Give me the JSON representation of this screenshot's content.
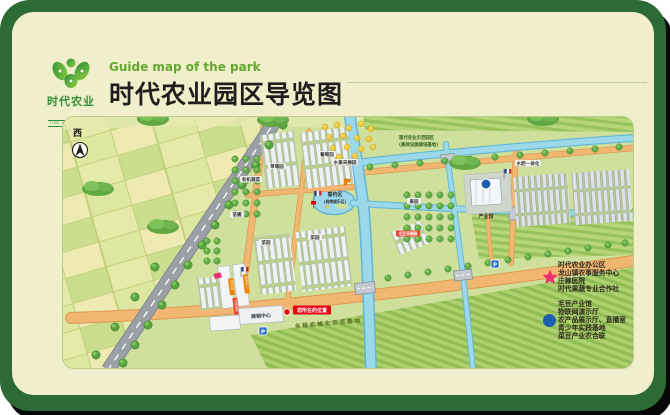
{
  "header": {
    "logo": {
      "name": "时代农业",
      "sub": "TIME AGRICULTURE"
    },
    "title_en": "Guide map of the park",
    "title_cn": "时代农业园区导览图"
  },
  "map": {
    "compass": "西",
    "labels": {
      "grape": "葡萄园",
      "strawberry": "草莓园",
      "organic": "有机蔬菜",
      "nursery": "苗圃",
      "veg": "菜园",
      "orchard": "果园",
      "fruit_pick": "水果采摘园",
      "fishing": "垂钓区",
      "fishing_sub": "(烧烤娱乐区)",
      "zone_line1": "现代农业示范园区",
      "zone_line2": "(高效设施栽培基地)",
      "water_fert": "水肥一体化",
      "industry_hall": "产业馆",
      "edamame": "毛豆采摘园",
      "exhibition": "展销中心",
      "you_are_here": "您所在的位置",
      "mechanization": "全程机械化示范基地",
      "parking": "P"
    },
    "tags": {
      "t1": "办公区",
      "t2": "服务中心",
      "t3": "庄稼医院"
    }
  },
  "legend": {
    "star": {
      "items": [
        "时代农业办公区",
        "龙山镇农事服务中心",
        "庄稼医院",
        "时代果蔬专业合作社"
      ]
    },
    "dot": {
      "items": [
        "毛豆产业馆",
        "物联网演示厅",
        "农产品展示厅、直播室",
        "青少年实践基地",
        "菜豆产业农合联"
      ]
    }
  },
  "colors": {
    "frame_green": "#2c6b35",
    "card_cream": "#f1eecb",
    "map_green": "#cfe09d",
    "accent_green": "#64a72e",
    "star_pink": "#ee2d6e",
    "dot_blue": "#1c5fae",
    "river_blue": "#9bd9ea",
    "road_orange": "#f1b671",
    "marker_red": "#e60012"
  }
}
